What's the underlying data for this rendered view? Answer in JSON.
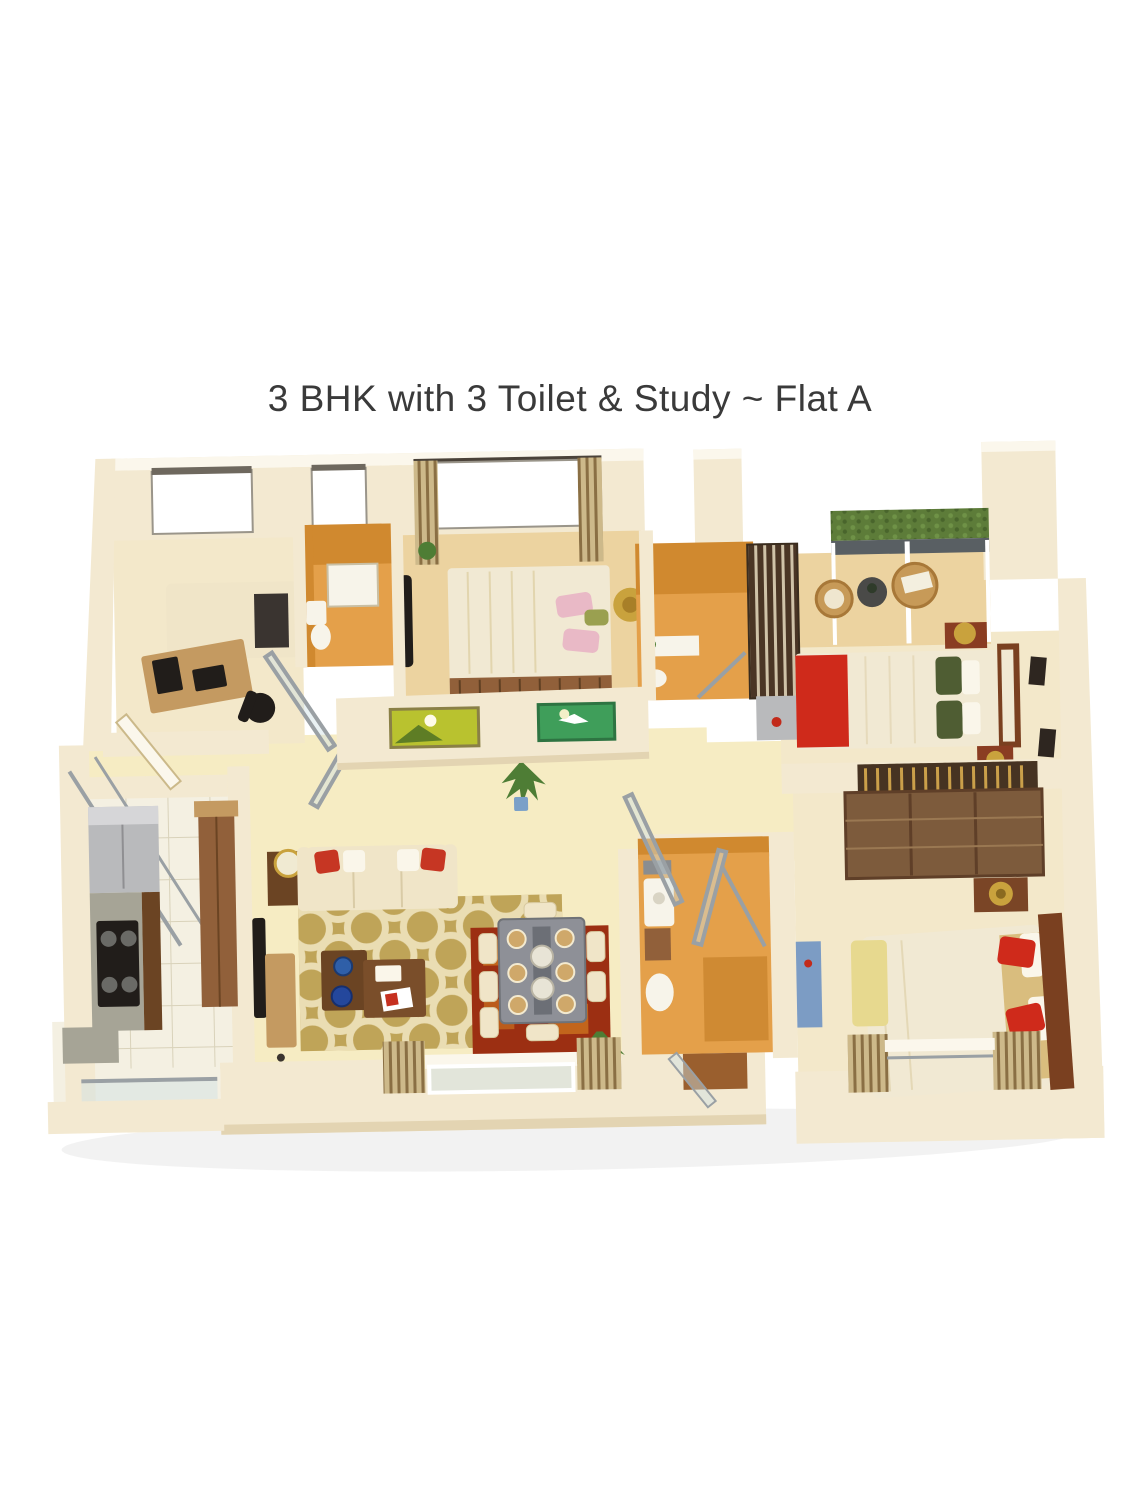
{
  "title": "3 BHK with 3 Toilet & Study ~ Flat A",
  "palette": {
    "background": "#ffffff",
    "title_color": "#3a3a3a",
    "wall_face": "#f3e9d1",
    "wall_shade": "#e3d4b2",
    "wall_top": "#fbf7ec",
    "floor_hall": "#f6ecc3",
    "floor_warm": "#ecd3a0",
    "floor_cream": "#f3e8ca",
    "floor_tile": "#f4f0e2",
    "tile_line": "#d9d2ba",
    "toilet_wall": "#d0892f",
    "toilet_floor": "#e4a04a",
    "toilet_floor_dark": "#cf8a33",
    "rug_olive": "#bfa458",
    "rug_pattern": "#efe3bd",
    "rug_red": "#9c2f12",
    "rug_red_sq": "#c96f1f",
    "sofa_cream": "#f0e5c8",
    "pillow_red": "#c63623",
    "pillow_white": "#faf6ea",
    "wood_dark": "#6b4423",
    "wood_mid": "#91603a",
    "wood_light": "#c49a61",
    "bed_duvet": "#f1e9d3",
    "bed_tan": "#d9bd7e",
    "red_accent": "#cf2a1b",
    "green_pillow": "#4f5d33",
    "wardrobe": "#7d5b3c",
    "headboard": "#7a4020",
    "bench_yellow": "#e7d98f",
    "tv_black": "#211d1a",
    "steel": "#b9babc",
    "granite": "#a6a496",
    "glass": "#cfe0e4",
    "frame_metal": "#9aa0a4",
    "hedge": "#5d7c39",
    "rail_dark": "#595f63",
    "wicker": "#c79a58",
    "gold": "#c9a23d",
    "curtain": "#cdb98a",
    "curtain_dark": "#8a6f44",
    "plant": "#4e7d35",
    "painting_yellow": "#b9c22f",
    "painting_green": "#3f9e5a",
    "blue_cabinet": "#7c9cc4",
    "basin_white": "#f7f4ea"
  }
}
